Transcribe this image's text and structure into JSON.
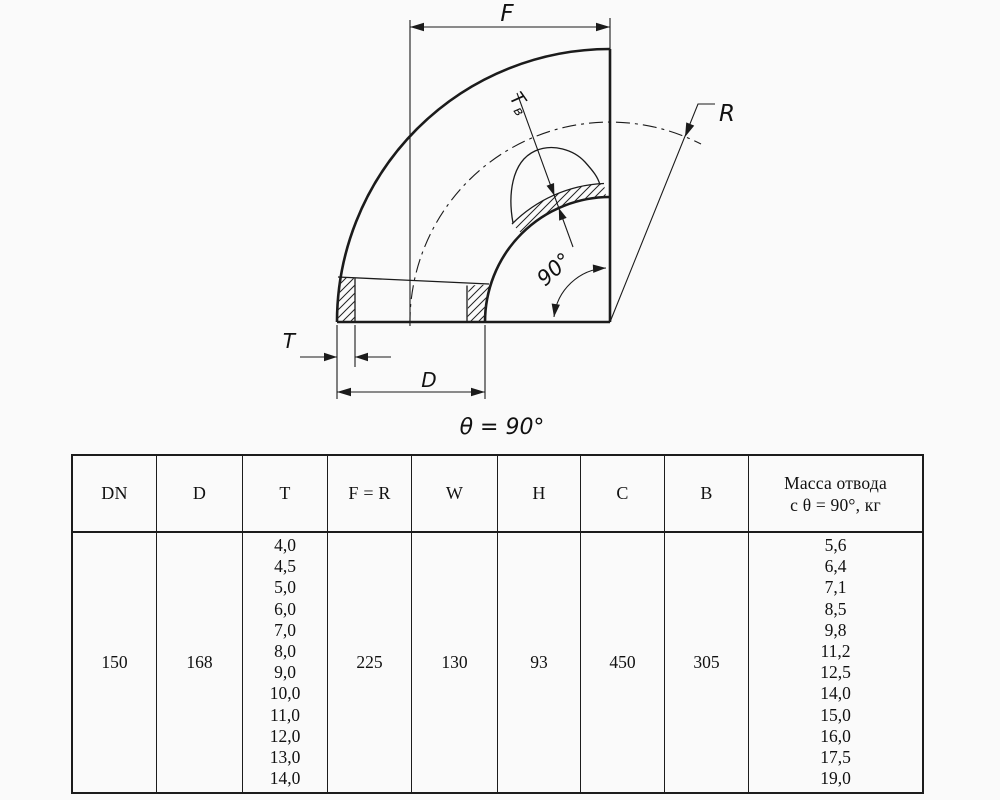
{
  "drawing": {
    "f_label": "F",
    "r_label": "R",
    "t_label": "T",
    "d_label": "D",
    "tv_label_main": "Т",
    "tv_label_sub": "в",
    "angle_label": "90°",
    "caption": "θ = 90°"
  },
  "table": {
    "columns": [
      {
        "key": "dn",
        "header": "DN",
        "value": "150"
      },
      {
        "key": "d",
        "header": "D",
        "value": "168"
      },
      {
        "key": "t",
        "header": "T",
        "values": [
          "4,0",
          "4,5",
          "5,0",
          "6,0",
          "7,0",
          "8,0",
          "9,0",
          "10,0",
          "11,0",
          "12,0",
          "13,0",
          "14,0"
        ]
      },
      {
        "key": "fr",
        "header": "F = R",
        "value": "225"
      },
      {
        "key": "w",
        "header": "W",
        "value": "130"
      },
      {
        "key": "h",
        "header": "H",
        "value": "93"
      },
      {
        "key": "c",
        "header": "C",
        "value": "450"
      },
      {
        "key": "b",
        "header": "B",
        "value": "305"
      },
      {
        "key": "mass",
        "header_lines": [
          "Масса отвода",
          "с θ =  90°, кг"
        ],
        "values": [
          "5,6",
          "6,4",
          "7,1",
          "8,5",
          "9,8",
          "11,2",
          "12,5",
          "14,0",
          "15,0",
          "16,0",
          "17,5",
          "19,0"
        ]
      }
    ]
  }
}
